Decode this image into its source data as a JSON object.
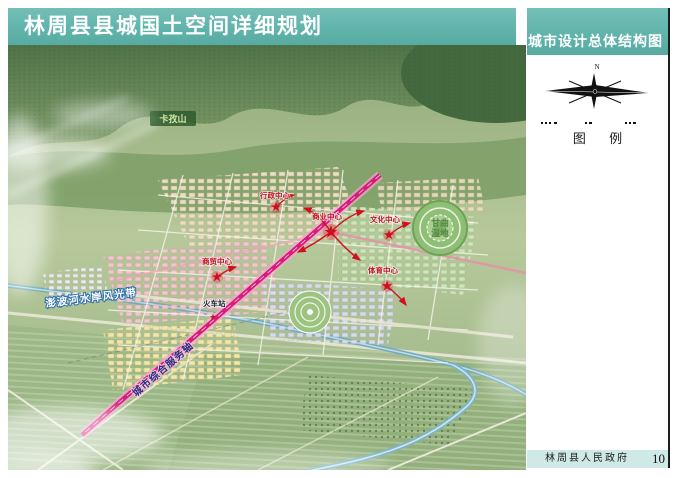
{
  "header": {
    "title": "林周县县城国土空间详细规划",
    "map_title": "城市设计总体结构图"
  },
  "sidebar": {
    "compass_north": "N",
    "legend_title": "图 例"
  },
  "footer": {
    "publisher": "林周县人民政府",
    "page_number": "10"
  },
  "map": {
    "mountain_label": "卡孜山",
    "wetland_label": {
      "line1": "甘曲",
      "line2": "湿地"
    },
    "river_belt_label": "澎波河水岸风光带",
    "axis_label": "城市综合服务轴",
    "station_label": "火车站",
    "centers": [
      {
        "label": "行政中心"
      },
      {
        "label": "商业中心"
      },
      {
        "label": "文化中心"
      },
      {
        "label": "商贸中心"
      },
      {
        "label": "体育中心"
      }
    ]
  },
  "colors": {
    "banner_teal": "#5fb3ab",
    "footer_cyan": "#cfe9e6",
    "axis_magenta": "#d81b7c",
    "river_blue": "#6fa9bf",
    "marker_red": "#cc1020",
    "mountain_green": "#55774d"
  }
}
